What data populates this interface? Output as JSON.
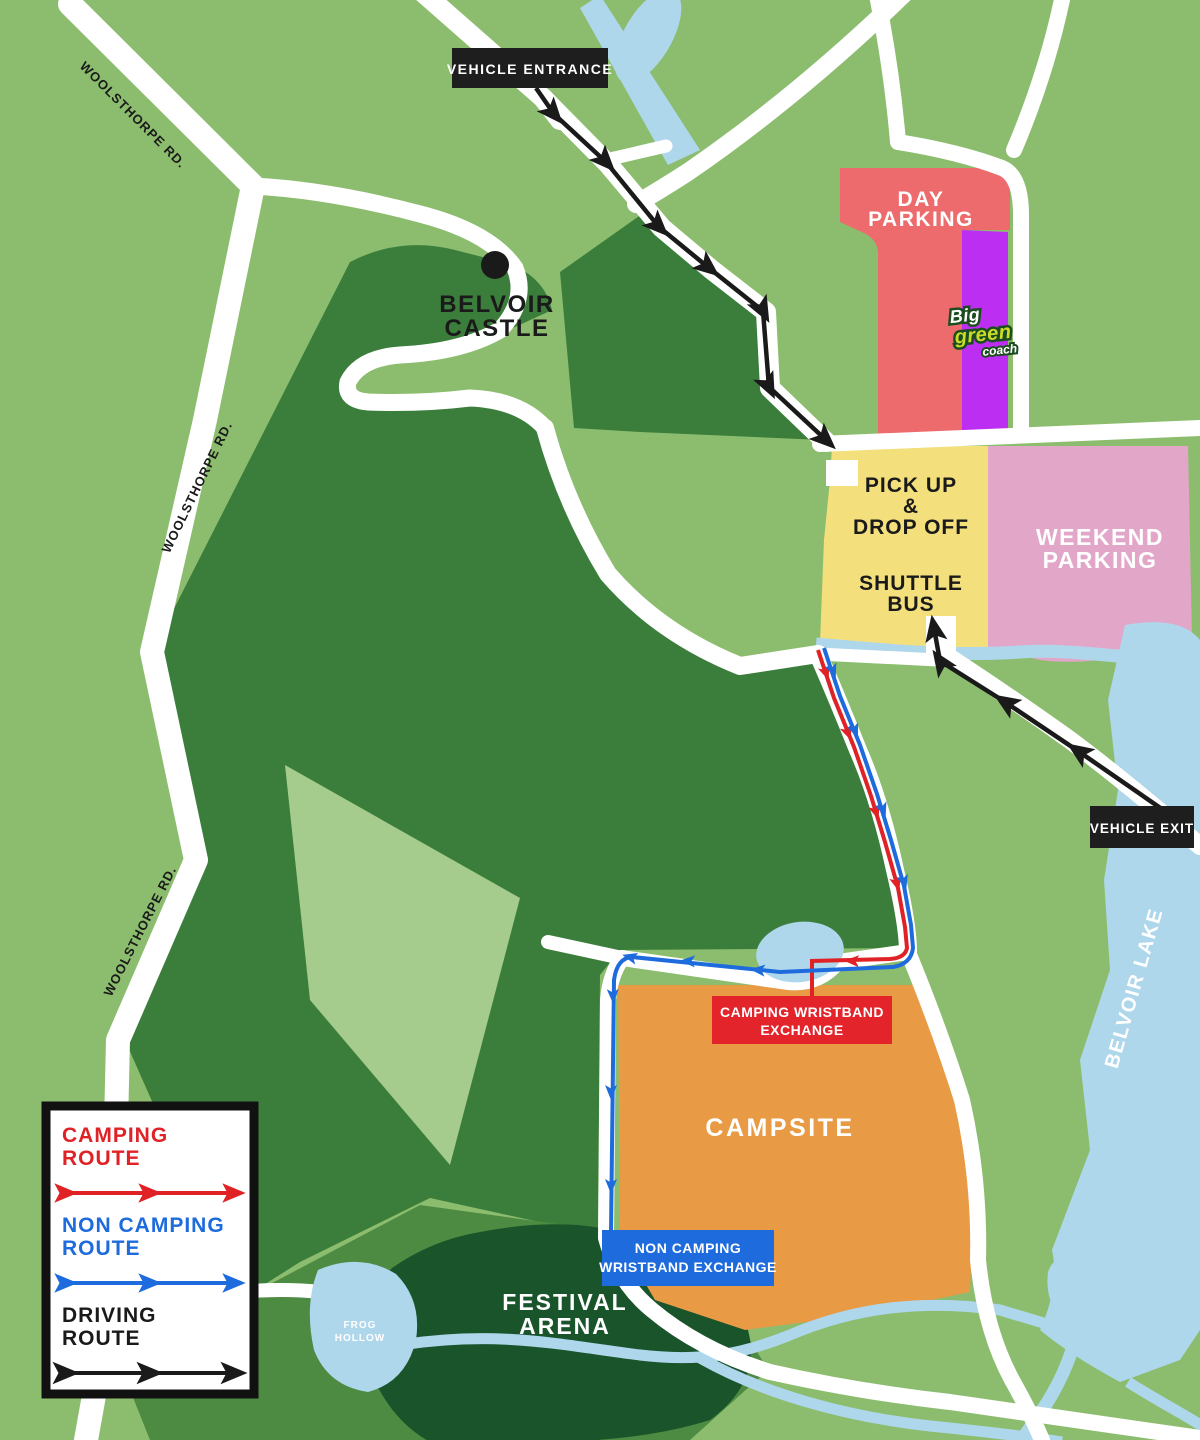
{
  "map": {
    "colors": {
      "background": "#8CBD6E",
      "forest": "#3B7E3C",
      "forest_light_patch": "#A5CC8C",
      "arena_surround": "#4E8B42",
      "festival_arena": "#1A542B",
      "water": "#AFD7EC",
      "road": "#FFFFFF",
      "campsite": "#E89A45",
      "day_parking": "#ED6B6C",
      "coach_parking": "#BC2FF2",
      "pickup_dropoff": "#F3DF7B",
      "weekend_parking": "#E2A6C9",
      "route_camping": "#E02227",
      "route_non_camping": "#1D6BDC",
      "route_driving": "#1A1A1A",
      "label_box": "#1E1E1E"
    },
    "labels": {
      "vehicle_entrance": "VEHICLE ENTRANCE",
      "vehicle_exit": "VEHICLE EXIT",
      "woolsthorpe_rd": "WOOLSTHORPE RD.",
      "belvoir_castle": [
        "BELVOIR",
        "CASTLE"
      ],
      "day_parking": [
        "DAY",
        "PARKING"
      ],
      "coach_logo": [
        "Big",
        "green",
        "coach"
      ],
      "pickup_dropoff": [
        "PICK UP",
        "&",
        "DROP OFF"
      ],
      "shuttle_bus": [
        "SHUTTLE",
        "BUS"
      ],
      "weekend_parking": [
        "WEEKEND",
        "PARKING"
      ],
      "belvoir_lake": "BELVOIR LAKE",
      "campsite": "CAMPSITE",
      "camping_wristband": [
        "CAMPING WRISTBAND",
        "EXCHANGE"
      ],
      "non_camping_wristband": [
        "NON CAMPING",
        "WRISTBAND EXCHANGE"
      ],
      "festival_arena": [
        "FESTIVAL",
        "ARENA"
      ],
      "frog_hollow": [
        "FROG",
        "HOLLOW"
      ]
    },
    "legend": {
      "items": [
        {
          "lines": [
            "CAMPING",
            "ROUTE"
          ],
          "color": "#E02227"
        },
        {
          "lines": [
            "NON CAMPING",
            "ROUTE"
          ],
          "color": "#1D6BDC"
        },
        {
          "lines": [
            "DRIVING",
            "ROUTE"
          ],
          "color": "#1A1A1A"
        }
      ]
    }
  }
}
